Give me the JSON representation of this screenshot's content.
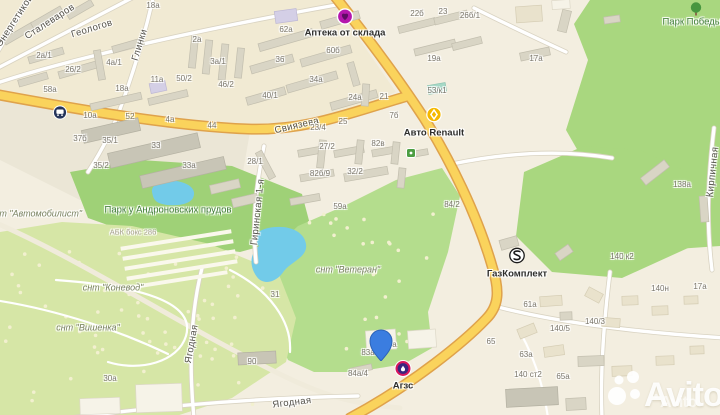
{
  "map": {
    "colors": {
      "background": "#f3eee0",
      "road_major": "#fad35c",
      "road_major_casing": "#dfa24b",
      "road_minor": "#ffffff",
      "park_green": "#a9d77f",
      "snt_green": "#d6e6a6",
      "water": "#72cbe9",
      "building": "#d9d5c5",
      "pin_blue": "#3b7de0",
      "pharmacy_purple": "#b517ad",
      "renault_yellow": "#f5b800",
      "gas_red": "#d8175d"
    },
    "streets": [
      {
        "name": "Энергетиков",
        "x": 15,
        "y": 21,
        "angle": -57
      },
      {
        "name": "Сталеваров",
        "x": 50,
        "y": 22,
        "angle": -33
      },
      {
        "name": "Геологов",
        "x": 92,
        "y": 29,
        "angle": -17
      },
      {
        "name": "Глинки",
        "x": 140,
        "y": 45,
        "angle": -73
      },
      {
        "name": "Свиязева",
        "x": 297,
        "y": 126,
        "angle": -13
      },
      {
        "name": "Гиринская 1-я",
        "x": 258,
        "y": 212,
        "angle": -84
      },
      {
        "name": "Ягодная",
        "x": 192,
        "y": 344,
        "angle": -80
      },
      {
        "name": "Ягодная",
        "x": 292,
        "y": 403,
        "angle": -7
      },
      {
        "name": "Кирпичная",
        "x": 713,
        "y": 172,
        "angle": -84
      }
    ],
    "areas": [
      {
        "name": "Парк Победы",
        "type": "park",
        "x": 692,
        "y": 22
      },
      {
        "name": "Парк у Андроновских прудов",
        "type": "park",
        "x": 168,
        "y": 210
      },
      {
        "name": "снт \"Автомобилист\"",
        "type": "snt",
        "x": 36,
        "y": 214
      },
      {
        "name": "снт \"Коневод\"",
        "type": "snt",
        "x": 113,
        "y": 288
      },
      {
        "name": "снт \"Вишенка\"",
        "type": "snt",
        "x": 88,
        "y": 328
      },
      {
        "name": "снт \"Ветеран\"",
        "type": "snt",
        "x": 348,
        "y": 270
      },
      {
        "name": "АБК бокс 286",
        "type": "note",
        "x": 133,
        "y": 232
      }
    ],
    "house_numbers": [
      {
        "t": "18а",
        "x": 153,
        "y": 6
      },
      {
        "t": "2а/1",
        "x": 44,
        "y": 56
      },
      {
        "t": "26/2",
        "x": 73,
        "y": 70
      },
      {
        "t": "4а/1",
        "x": 114,
        "y": 63
      },
      {
        "t": "2а",
        "x": 197,
        "y": 40
      },
      {
        "t": "3а/1",
        "x": 218,
        "y": 62
      },
      {
        "t": "11а",
        "x": 157,
        "y": 80
      },
      {
        "t": "50/2",
        "x": 184,
        "y": 79
      },
      {
        "t": "46/2",
        "x": 226,
        "y": 85
      },
      {
        "t": "18а",
        "x": 122,
        "y": 89
      },
      {
        "t": "58а",
        "x": 50,
        "y": 90
      },
      {
        "t": "10а",
        "x": 90,
        "y": 116
      },
      {
        "t": "52",
        "x": 130,
        "y": 117
      },
      {
        "t": "4а",
        "x": 170,
        "y": 120
      },
      {
        "t": "44",
        "x": 212,
        "y": 126
      },
      {
        "t": "37б",
        "x": 80,
        "y": 139
      },
      {
        "t": "35/1",
        "x": 110,
        "y": 141
      },
      {
        "t": "35/2",
        "x": 101,
        "y": 166
      },
      {
        "t": "33",
        "x": 156,
        "y": 146
      },
      {
        "t": "33а",
        "x": 189,
        "y": 166
      },
      {
        "t": "62а",
        "x": 286,
        "y": 30
      },
      {
        "t": "36",
        "x": 280,
        "y": 60
      },
      {
        "t": "60б",
        "x": 333,
        "y": 51
      },
      {
        "t": "34а",
        "x": 316,
        "y": 80
      },
      {
        "t": "40/1",
        "x": 270,
        "y": 96
      },
      {
        "t": "22б",
        "x": 417,
        "y": 14
      },
      {
        "t": "23",
        "x": 443,
        "y": 12
      },
      {
        "t": "26б/1",
        "x": 470,
        "y": 16
      },
      {
        "t": "19а",
        "x": 434,
        "y": 59
      },
      {
        "t": "53/к1",
        "x": 437,
        "y": 91
      },
      {
        "t": "24а",
        "x": 355,
        "y": 98
      },
      {
        "t": "21",
        "x": 384,
        "y": 97
      },
      {
        "t": "7б",
        "x": 394,
        "y": 116
      },
      {
        "t": "23/4",
        "x": 318,
        "y": 128
      },
      {
        "t": "25",
        "x": 343,
        "y": 122
      },
      {
        "t": "27/2",
        "x": 327,
        "y": 147
      },
      {
        "t": "28/1",
        "x": 255,
        "y": 162
      },
      {
        "t": "82в",
        "x": 378,
        "y": 144
      },
      {
        "t": "82б/9",
        "x": 320,
        "y": 174
      },
      {
        "t": "32/2",
        "x": 355,
        "y": 172
      },
      {
        "t": "59а",
        "x": 340,
        "y": 207
      },
      {
        "t": "84/2",
        "x": 452,
        "y": 205
      },
      {
        "t": "17а",
        "x": 536,
        "y": 59
      },
      {
        "t": "138а",
        "x": 682,
        "y": 185
      },
      {
        "t": "140 к2",
        "x": 622,
        "y": 257
      },
      {
        "t": "61а",
        "x": 530,
        "y": 305
      },
      {
        "t": "140/5",
        "x": 560,
        "y": 329
      },
      {
        "t": "140/3",
        "x": 595,
        "y": 322
      },
      {
        "t": "140н",
        "x": 660,
        "y": 289
      },
      {
        "t": "17а",
        "x": 700,
        "y": 287
      },
      {
        "t": "65",
        "x": 491,
        "y": 342
      },
      {
        "t": "63а",
        "x": 526,
        "y": 355
      },
      {
        "t": "140 ст2",
        "x": 528,
        "y": 375
      },
      {
        "t": "65а",
        "x": 563,
        "y": 377
      },
      {
        "t": "90",
        "x": 252,
        "y": 362
      },
      {
        "t": "31",
        "x": 275,
        "y": 295
      },
      {
        "t": "83а",
        "x": 368,
        "y": 353
      },
      {
        "t": "84а",
        "x": 390,
        "y": 345
      },
      {
        "t": "84а/4",
        "x": 358,
        "y": 374
      },
      {
        "t": "30а",
        "x": 110,
        "y": 379
      }
    ],
    "pois": [
      {
        "label": "Аптека от склада",
        "icon": "pharmacy-heart-icon",
        "x": 345,
        "y": 19,
        "label_dy": 14
      },
      {
        "label": "Авто Renault",
        "icon": "renault-icon",
        "x": 434,
        "y": 117,
        "label_dy": 16
      },
      {
        "label": "ГазКомплект",
        "icon": "gazkomplekt-icon",
        "x": 517,
        "y": 258,
        "label_dy": 16
      },
      {
        "label": "Агзс",
        "icon": "gas-station-icon",
        "x": 403,
        "y": 371,
        "label_dy": 15
      },
      {
        "label": "",
        "icon": "bus-stop-icon",
        "x": 60,
        "y": 115,
        "label_dy": 0
      },
      {
        "label": "",
        "icon": "tree-icon",
        "x": 696,
        "y": 11,
        "label_dy": 0
      },
      {
        "label": "",
        "icon": "leisure-icon",
        "x": 411,
        "y": 154,
        "label_dy": 0
      }
    ],
    "marker": {
      "x": 381,
      "y": 366
    },
    "watermark": {
      "main": "Avito",
      "secondary": "Avito"
    }
  }
}
